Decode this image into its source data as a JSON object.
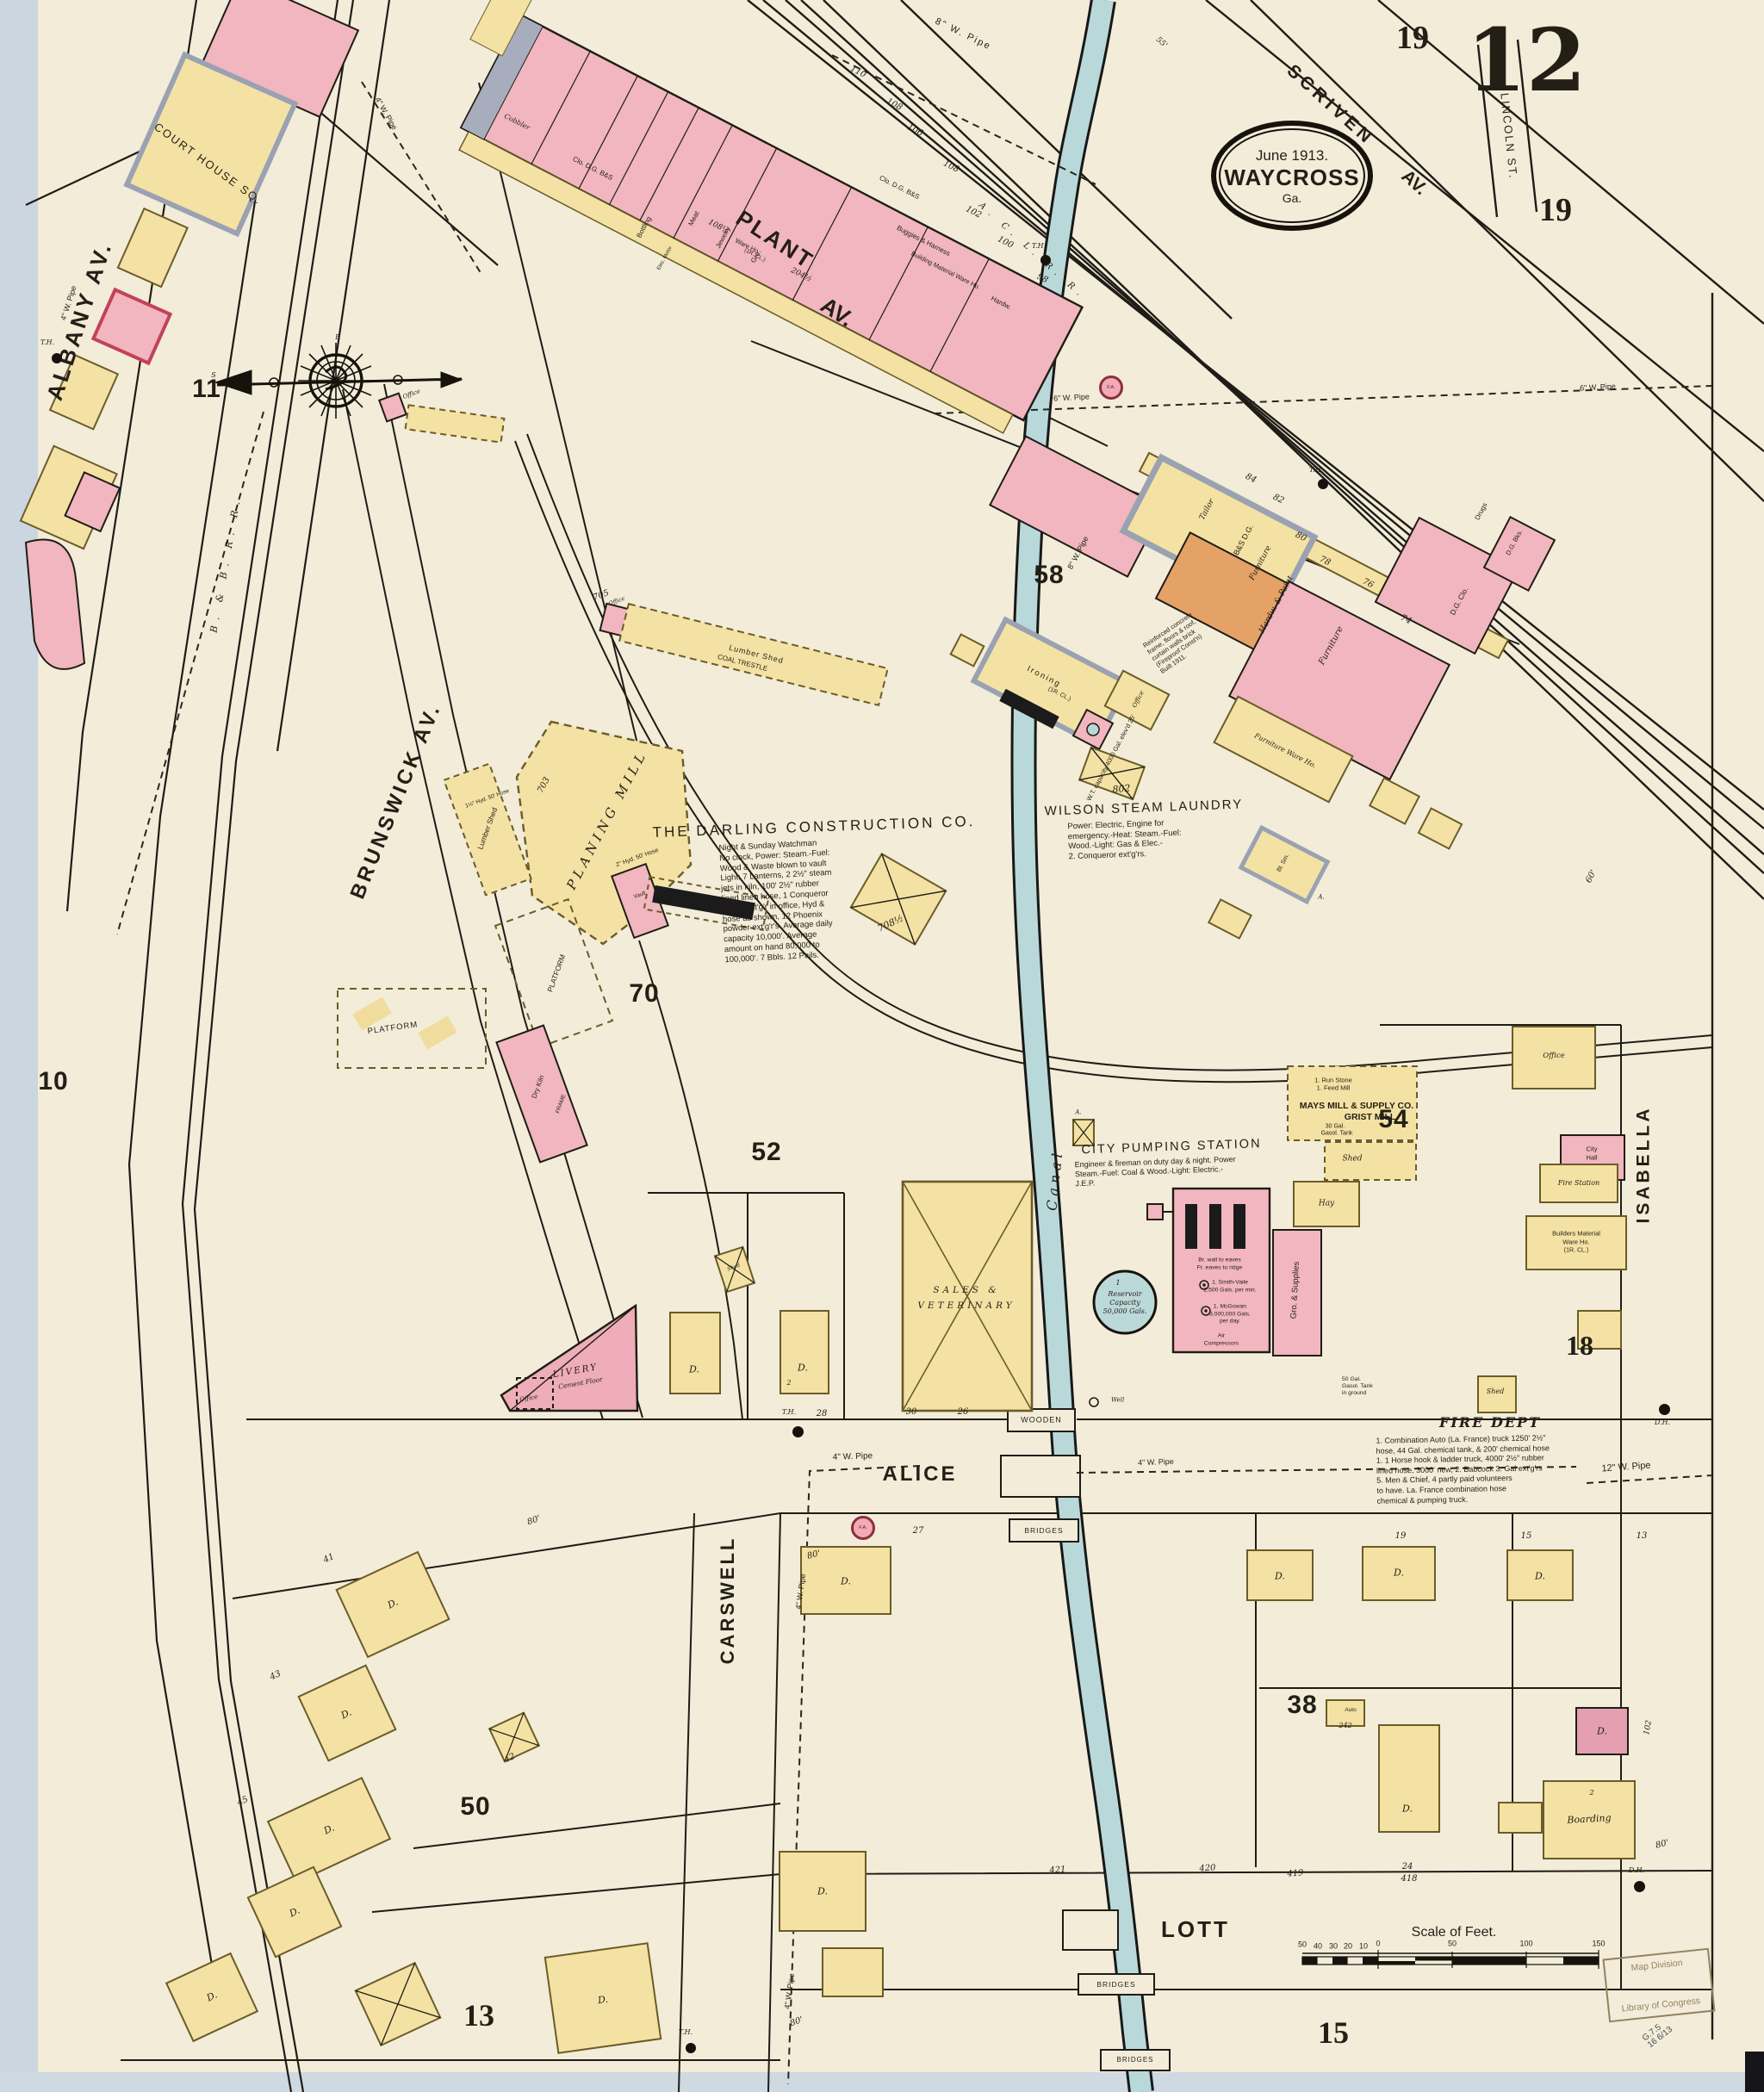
{
  "sheet": {
    "number": "12",
    "top": "19",
    "right_top": "19",
    "right_bottom": "18",
    "bottom_right": "15",
    "bottom_left": "13"
  },
  "oval": {
    "date": "June 1913.",
    "city": "WAYCROSS",
    "state": "Ga."
  },
  "loc_stamp": {
    "line1": "Map Division",
    "line2": "Library of Congress"
  },
  "pencil": {
    "line1": "G.7.5",
    "line2": "16 6/13"
  },
  "scale": {
    "title": "Scale of Feet.",
    "t1": "50",
    "t2": "40",
    "t3": "30",
    "t4": "20",
    "t5": "10",
    "t6": "0",
    "t7": "50",
    "t8": "100",
    "t9": "150"
  },
  "compass": {
    "e": "E",
    "s": "S"
  },
  "streets": {
    "albany": "ALBANY AV.",
    "brunswick": "BRUNSWICK AV.",
    "plant": "PLANT",
    "plant_av": "AV.",
    "scriven": "SCRIVEN",
    "scriven_av": "AV.",
    "lincoln": "LINCOLN ST.",
    "isabella": "ISABELLA",
    "alice": "ALICE",
    "carswell": "CARSWELL",
    "lott": "LOTT",
    "courthouse": "COURT HOUSE SQ.",
    "canal": "Canal"
  },
  "railroads": {
    "bbrr": "B. & B. R. R.",
    "aclrr": "A. C. L. R. R.",
    "coal_trestle": "COAL TRESTLE"
  },
  "blocks": {
    "b10": "10",
    "b11": "11",
    "b38": "38",
    "b50": "50",
    "b52": "52",
    "b54": "54",
    "b58": "58",
    "b70": "70"
  },
  "annotations": {
    "darling": {
      "title": "THE DARLING CONSTRUCTION CO.",
      "lines": [
        "Night & Sunday Watchman",
        "No clock, Power: Steam.-Fuel:",
        "Wood & Waste blown to vault",
        "Light: 7 Lanterns, 2 2½\" steam",
        "jets in kiln, 100' 2½\" rubber",
        "lined linen hose, 1 Conqueror",
        "3 Gal. ext'g'r in office, Hyd &",
        "hose as shown, 12 Phoenix",
        "powder ext'g'r's. Average daily",
        "capacity 10,000'. Average",
        "amount on hand 80,000 to",
        "100,000'. 7 Bbls. 12 Pails."
      ]
    },
    "wilson": {
      "title": "WILSON STEAM LAUNDRY",
      "lines": [
        "Power: Electric, Engine for",
        "emergency.-Heat: Steam.-Fuel:",
        "Wood.-Light: Gas & Elec.-",
        "2. Conqueror ext'g'rs."
      ]
    },
    "pumping": {
      "title": "CITY PUMPING STATION",
      "lines": [
        "Engineer & fireman on duty day & night. Power",
        "Steam.-Fuel: Coal & Wood.-Light: Electric.-",
        "J.E.P."
      ]
    },
    "fire_dept": {
      "title": "FIRE DEPT",
      "lines": [
        "1. Combination Auto (La. France) truck 1250' 2½\"",
        "hose, 44 Gal. chemical tank, & 200' chemical hose",
        "1. 1 Horse hook & ladder truck, 4000' 2½\" rubber",
        "lined hose, 3000' new, 2. Babcock 3. Gal ext'g'rs",
        "5. Men & Chief, 4 partly paid volunteers",
        "to have. La. France combination hose",
        "chemical & pumping truck."
      ]
    },
    "mays": {
      "title1": "MAYS MILL & SUPPLY CO.",
      "title2": "GRIST MILL.",
      "run_stone": "1. Run Stone",
      "feed_mill": "1. Feed Mill",
      "gasol1": "30 Gal.",
      "gasol2": "Gasol. Tank"
    },
    "reservoir": {
      "n": "1",
      "l1": "Reservoir",
      "l2": "Capacity",
      "l3": "50,000 Gals."
    },
    "pump_house": {
      "l1": "Br. wall to eaves",
      "l2": "Fr. eaves to ridge",
      "l3": "1. Smith-Vaile",
      "l4": "2,500 Gals. per min.",
      "l5": "1. McGowan",
      "l6": "3,000,000 Gals.",
      "l7": "per day.",
      "l8": "Air",
      "l9": "Compressors"
    },
    "fireproof": {
      "l1": "Reinforced concrete",
      "l2": "frame, floors & roof,",
      "l3": "curtain walls brick",
      "l4": "(Fireproof Const'n)",
      "l5": "Built 1911."
    },
    "wt": "W.T. capacity 4000 Gal. elev'd 25'",
    "gasol": {
      "l1": "50 Gal.",
      "l2": "Gasol. Tank",
      "l3": "in ground"
    },
    "hyd2": "2\" Hyd. 50' Hose",
    "hyd15": "1½\" Hyd. 50' Hose"
  },
  "labels": {
    "planing_mill": "PLANING MILL",
    "lumber_shed": "Lumber Shed",
    "office": "Office",
    "platform": "PLATFORM",
    "dry_kiln": "Dry Kiln",
    "frame": "FRAME",
    "vault": "Vault",
    "ironing": "Ironing",
    "ir_cl": "(1R. CL.)",
    "sales1": "SALES &",
    "sales2": "VETERINARY",
    "livery": "LIVERY",
    "cement": "Cement Floor",
    "shed": "Shed",
    "hay": "Hay",
    "gro_supplies": "Gro. & Supplies",
    "city": "City",
    "hall": "Hall",
    "fire_station": "Fire Station",
    "builders1": "Builders Material",
    "builders2": "Ware Ho.",
    "boarding": "Boarding",
    "bl_sm": "Bl. Sm.",
    "a": "A.",
    "auto": "Auto",
    "dwelling": "D.",
    "two": "2",
    "cobbler": "Cobbler",
    "clo_dg": "Clo. D.G. B&S",
    "bottling": "Bottling",
    "elec_motor": "Elec. Motor",
    "meat": "Meat",
    "jewelry": "Jewelry",
    "gro": "Gro.",
    "buggies": "Buggies & Harness",
    "bmwh": "Building Material Ware Ho.",
    "hardw": "Hardw.",
    "ware_ho": "Ware Ho.",
    "tailor": "Tailor",
    "bs_dg": "B&S D.G.",
    "furniture": "Furniture",
    "hardw_paint": "Hardw. & Paint",
    "dg_clo": "D.G. Clo.",
    "drugs": "Drugs",
    "dg_bks": "D.G. Bks.",
    "furn_wh": "Furniture Ware Ho."
  },
  "symbols": {
    "th": "T.H.",
    "dh": "D.H.",
    "fa": "F.A.",
    "well": "Well",
    "wooden": "WOODEN",
    "bridges": "BRIDGES"
  },
  "pipes": {
    "p4": "4\" W. Pipe",
    "p6": "6\" W. Pipe",
    "p8": "8\" W. Pipe",
    "p12": "12\" W. Pipe"
  },
  "numbers": {
    "n110": "110",
    "n108": "108",
    "n106": "106",
    "n102": "102",
    "n100": "100",
    "n98": "98",
    "n84": "84",
    "n82": "82",
    "n80": "80",
    "n78": "78",
    "n76": "76",
    "n74": "74",
    "n705": "705",
    "n703": "703",
    "n708h": "708½",
    "n802": "802",
    "n2045": "204½",
    "n1085": "108½",
    "n60": "60'",
    "n55": "55'",
    "n30": "30",
    "n28": "28",
    "n26": "26",
    "n27": "27",
    "n24": "24",
    "n418": "418",
    "n419": "419",
    "n420": "420",
    "n421": "421",
    "n41": "41",
    "n43": "43",
    "n45": "45",
    "n42": "42",
    "n19": "19",
    "n15": "15",
    "n13": "13",
    "n242": "242",
    "n80ft": "80'"
  }
}
